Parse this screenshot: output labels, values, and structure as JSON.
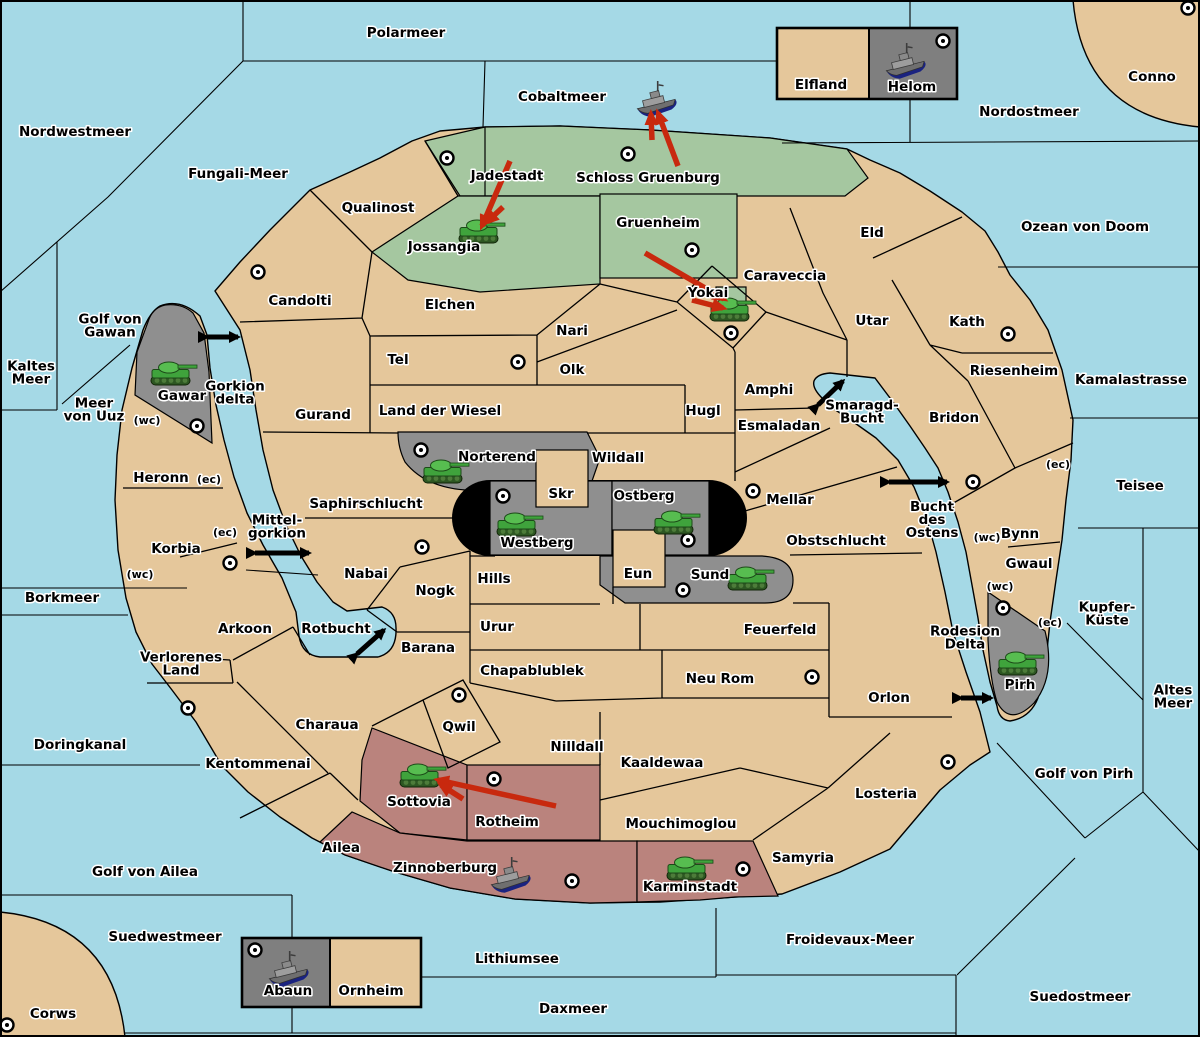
{
  "map": {
    "colors": {
      "sea": "#A5D9E6",
      "land_neutral": "#E5C79B",
      "power_green": "#A5C7A0",
      "power_gray": "#8F8F8F",
      "power_pink": "#BA837D",
      "island_box_gray": "#7F7F7F",
      "tunnel_black": "#000000",
      "order_arrow_red": "#C8290E",
      "strait_arrow_black": "#000000",
      "border": "#000000"
    },
    "sea_labels": [
      {
        "text": "Polarmeer",
        "x": 406,
        "y": 37
      },
      {
        "text": "Nordwestmeer",
        "x": 75,
        "y": 136
      },
      {
        "text": "Fungali-Meer",
        "x": 238,
        "y": 178
      },
      {
        "text": "Cobaltmeer",
        "x": 562,
        "y": 101
      },
      {
        "text": "Nordostmeer",
        "x": 1029,
        "y": 116
      },
      {
        "text": "Ozean von Doom",
        "x": 1085,
        "y": 231
      },
      {
        "text": "Kaltes\nMeer",
        "x": 31,
        "y": 377
      },
      {
        "text": "Golf von\nGawan",
        "x": 110,
        "y": 330
      },
      {
        "text": "Meer\nvon Uuz",
        "x": 94,
        "y": 414
      },
      {
        "text": "Gorkion\ndelta",
        "x": 235,
        "y": 397
      },
      {
        "text": "Mittel-\ngorkion",
        "x": 277,
        "y": 531
      },
      {
        "text": "Kamalastrasse",
        "x": 1131,
        "y": 384
      },
      {
        "text": "Smaragd-\nBucht",
        "x": 862,
        "y": 416
      },
      {
        "text": "Teisee",
        "x": 1140,
        "y": 490
      },
      {
        "text": "Bucht\ndes\nOstens",
        "x": 932,
        "y": 524
      },
      {
        "text": "Borkmeer",
        "x": 62,
        "y": 602
      },
      {
        "text": "Rotbucht",
        "x": 336,
        "y": 633
      },
      {
        "text": "Kupfer-\nKüste",
        "x": 1107,
        "y": 618
      },
      {
        "text": "Altes\nMeer",
        "x": 1173,
        "y": 701
      },
      {
        "text": "Golf von Pirh",
        "x": 1084,
        "y": 778
      },
      {
        "text": "Rodesion\nDelta",
        "x": 965,
        "y": 642
      },
      {
        "text": "Doringkanal",
        "x": 80,
        "y": 749
      },
      {
        "text": "Golf von Ailea",
        "x": 145,
        "y": 876
      },
      {
        "text": "Suedwestmeer",
        "x": 165,
        "y": 941
      },
      {
        "text": "Lithiumsee",
        "x": 517,
        "y": 963
      },
      {
        "text": "Daxmeer",
        "x": 573,
        "y": 1013
      },
      {
        "text": "Froidevaux-Meer",
        "x": 850,
        "y": 944
      },
      {
        "text": "Suedostmeer",
        "x": 1080,
        "y": 1001
      }
    ],
    "region_labels": [
      {
        "text": "Qualinost",
        "x": 378,
        "y": 212
      },
      {
        "text": "Jadestadt",
        "x": 507,
        "y": 180
      },
      {
        "text": "Schloss Gruenburg",
        "x": 648,
        "y": 182
      },
      {
        "text": "Jossangia",
        "x": 444,
        "y": 251
      },
      {
        "text": "Gruenheim",
        "x": 658,
        "y": 227
      },
      {
        "text": "Yokai",
        "x": 708,
        "y": 297
      },
      {
        "text": "Caraveccia",
        "x": 785,
        "y": 280
      },
      {
        "text": "Eld",
        "x": 872,
        "y": 237
      },
      {
        "text": "Utar",
        "x": 872,
        "y": 325
      },
      {
        "text": "Kath",
        "x": 967,
        "y": 326
      },
      {
        "text": "Riesenheim",
        "x": 1014,
        "y": 375
      },
      {
        "text": "Bridon",
        "x": 954,
        "y": 422
      },
      {
        "text": "Candolti",
        "x": 300,
        "y": 305
      },
      {
        "text": "Elchen",
        "x": 450,
        "y": 309
      },
      {
        "text": "Nari",
        "x": 572,
        "y": 335
      },
      {
        "text": "Tel",
        "x": 398,
        "y": 364
      },
      {
        "text": "Olk",
        "x": 572,
        "y": 374
      },
      {
        "text": "Gurand",
        "x": 323,
        "y": 419
      },
      {
        "text": "Land der Wiesel",
        "x": 440,
        "y": 415
      },
      {
        "text": "Hugl",
        "x": 703,
        "y": 415
      },
      {
        "text": "Amphi",
        "x": 769,
        "y": 394
      },
      {
        "text": "Esmaladan",
        "x": 779,
        "y": 430
      },
      {
        "text": "Mellar",
        "x": 790,
        "y": 504
      },
      {
        "text": "Obstschlucht",
        "x": 836,
        "y": 545
      },
      {
        "text": "Wildall",
        "x": 618,
        "y": 462
      },
      {
        "text": "Skr",
        "x": 561,
        "y": 498
      },
      {
        "text": "Ostberg",
        "x": 644,
        "y": 500
      },
      {
        "text": "Westberg",
        "x": 537,
        "y": 547
      },
      {
        "text": "Norterend",
        "x": 497,
        "y": 461
      },
      {
        "text": "Gawar",
        "x": 182,
        "y": 400
      },
      {
        "text": "Heronn",
        "x": 161,
        "y": 482
      },
      {
        "text": "Korbia",
        "x": 176,
        "y": 553
      },
      {
        "text": "Saphirschlucht",
        "x": 366,
        "y": 508
      },
      {
        "text": "Nabai",
        "x": 366,
        "y": 578
      },
      {
        "text": "Nogk",
        "x": 435,
        "y": 595
      },
      {
        "text": "Hills",
        "x": 494,
        "y": 583
      },
      {
        "text": "Eun",
        "x": 638,
        "y": 578
      },
      {
        "text": "Sund",
        "x": 710,
        "y": 579
      },
      {
        "text": "Urur",
        "x": 497,
        "y": 631
      },
      {
        "text": "Barana",
        "x": 428,
        "y": 652
      },
      {
        "text": "Chapablublek",
        "x": 532,
        "y": 675
      },
      {
        "text": "Qwil",
        "x": 459,
        "y": 731
      },
      {
        "text": "Nilldall",
        "x": 577,
        "y": 751
      },
      {
        "text": "Kaaldewaa",
        "x": 662,
        "y": 767
      },
      {
        "text": "Neu Rom",
        "x": 720,
        "y": 683
      },
      {
        "text": "Feuerfeld",
        "x": 780,
        "y": 634
      },
      {
        "text": "Orlon",
        "x": 889,
        "y": 702
      },
      {
        "text": "Mouchimoglou",
        "x": 681,
        "y": 828
      },
      {
        "text": "Arkoon",
        "x": 245,
        "y": 633
      },
      {
        "text": "Verlorenes\nLand",
        "x": 181,
        "y": 668
      },
      {
        "text": "Kentommenai",
        "x": 258,
        "y": 768
      },
      {
        "text": "Charaua",
        "x": 327,
        "y": 729
      },
      {
        "text": "Ailea",
        "x": 341,
        "y": 852
      },
      {
        "text": "Losteria",
        "x": 886,
        "y": 798
      },
      {
        "text": "Samyria",
        "x": 803,
        "y": 862
      },
      {
        "text": "Sottovia",
        "x": 419,
        "y": 806
      },
      {
        "text": "Rotheim",
        "x": 507,
        "y": 826
      },
      {
        "text": "Zinnoberburg",
        "x": 445,
        "y": 872
      },
      {
        "text": "Karminstadt",
        "x": 690,
        "y": 891
      },
      {
        "text": "Bynn",
        "x": 1020,
        "y": 538
      },
      {
        "text": "Gwaul",
        "x": 1029,
        "y": 568
      },
      {
        "text": "Pirh",
        "x": 1020,
        "y": 689
      },
      {
        "text": "Conno",
        "x": 1152,
        "y": 81
      },
      {
        "text": "Corws",
        "x": 53,
        "y": 1018
      },
      {
        "text": "Elfland",
        "x": 821,
        "y": 89
      },
      {
        "text": "Helom",
        "x": 912,
        "y": 91
      },
      {
        "text": "Abaun",
        "x": 288,
        "y": 995
      },
      {
        "text": "Ornheim",
        "x": 371,
        "y": 995
      }
    ],
    "coast_markers": [
      {
        "text": "(wc)",
        "x": 147,
        "y": 424
      },
      {
        "text": "(ec)",
        "x": 209,
        "y": 483
      },
      {
        "text": "(ec)",
        "x": 225,
        "y": 536
      },
      {
        "text": "(wc)",
        "x": 140,
        "y": 578
      },
      {
        "text": "(ec)",
        "x": 1058,
        "y": 468
      },
      {
        "text": "(wc)",
        "x": 987,
        "y": 541
      },
      {
        "text": "(wc)",
        "x": 1000,
        "y": 590
      },
      {
        "text": "(ec)",
        "x": 1050,
        "y": 626
      }
    ],
    "supply_centers": [
      {
        "region": "Candolti",
        "x": 258,
        "y": 272
      },
      {
        "region": "Jadestadt",
        "x": 447,
        "y": 158
      },
      {
        "region": "Schloss Gruenburg",
        "x": 628,
        "y": 154
      },
      {
        "region": "Gruenheim",
        "x": 692,
        "y": 250
      },
      {
        "region": "Conno",
        "x": 1188,
        "y": 8
      },
      {
        "region": "Helom",
        "x": 943,
        "y": 41
      },
      {
        "region": "Yokai",
        "x": 731,
        "y": 333
      },
      {
        "region": "Tel",
        "x": 518,
        "y": 362
      },
      {
        "region": "Kath",
        "x": 1008,
        "y": 334
      },
      {
        "region": "Gawar",
        "x": 197,
        "y": 426
      },
      {
        "region": "Korbia",
        "x": 230,
        "y": 563
      },
      {
        "region": "Nabai",
        "x": 422,
        "y": 547
      },
      {
        "region": "Norterend",
        "x": 421,
        "y": 450
      },
      {
        "region": "Westberg",
        "x": 503,
        "y": 496
      },
      {
        "region": "Ostberg",
        "x": 688,
        "y": 540
      },
      {
        "region": "Mellar",
        "x": 753,
        "y": 491
      },
      {
        "region": "Sund",
        "x": 683,
        "y": 590
      },
      {
        "region": "Bynn",
        "x": 973,
        "y": 482
      },
      {
        "region": "Pirh",
        "x": 1003,
        "y": 608
      },
      {
        "region": "Kentommenai",
        "x": 188,
        "y": 708
      },
      {
        "region": "Qwil",
        "x": 459,
        "y": 695
      },
      {
        "region": "Neu Rom",
        "x": 812,
        "y": 677
      },
      {
        "region": "Losteria",
        "x": 948,
        "y": 762
      },
      {
        "region": "Rotheim",
        "x": 494,
        "y": 779
      },
      {
        "region": "Zinnoberburg",
        "x": 572,
        "y": 881
      },
      {
        "region": "Karminstadt",
        "x": 743,
        "y": 869
      },
      {
        "region": "Corws",
        "x": 7,
        "y": 1025
      },
      {
        "region": "Abaun",
        "x": 255,
        "y": 950
      }
    ],
    "units": [
      {
        "type": "army",
        "region": "Jossangia",
        "x": 481,
        "y": 232
      },
      {
        "type": "army",
        "region": "Yokai",
        "x": 732,
        "y": 310
      },
      {
        "type": "army",
        "region": "Gawar",
        "x": 173,
        "y": 374
      },
      {
        "type": "army",
        "region": "Norterend",
        "x": 445,
        "y": 472
      },
      {
        "type": "army",
        "region": "Westberg",
        "x": 519,
        "y": 525
      },
      {
        "type": "army",
        "region": "Ostberg",
        "x": 676,
        "y": 523
      },
      {
        "type": "army",
        "region": "Sund",
        "x": 750,
        "y": 579
      },
      {
        "type": "army",
        "region": "Sottovia",
        "x": 422,
        "y": 776
      },
      {
        "type": "army",
        "region": "Karminstadt",
        "x": 689,
        "y": 869
      },
      {
        "type": "army",
        "region": "Pirh",
        "x": 1020,
        "y": 664
      },
      {
        "type": "fleet",
        "region": "Cobaltmeer",
        "x": 656,
        "y": 101
      },
      {
        "type": "fleet",
        "region": "Helom",
        "x": 905,
        "y": 63
      },
      {
        "type": "fleet",
        "region": "Zinnoberburg",
        "x": 510,
        "y": 877
      },
      {
        "type": "fleet",
        "region": "Abaun",
        "x": 288,
        "y": 971
      }
    ],
    "move_arrows": [
      {
        "x1": 510,
        "y1": 161,
        "x2": 482,
        "y2": 226
      },
      {
        "x1": 503,
        "y1": 207,
        "x2": 487,
        "y2": 222
      },
      {
        "x1": 652,
        "y1": 140,
        "x2": 651,
        "y2": 114
      },
      {
        "x1": 678,
        "y1": 166,
        "x2": 658,
        "y2": 113
      },
      {
        "x1": 645,
        "y1": 253,
        "x2": 724,
        "y2": 299
      },
      {
        "x1": 692,
        "y1": 300,
        "x2": 723,
        "y2": 308
      },
      {
        "x1": 556,
        "y1": 806,
        "x2": 438,
        "y2": 780
      },
      {
        "x1": 463,
        "y1": 799,
        "x2": 441,
        "y2": 785
      }
    ],
    "strait_arrows": [
      {
        "x1": 207,
        "y1": 337,
        "x2": 238,
        "y2": 337
      },
      {
        "x1": 255,
        "y1": 553,
        "x2": 309,
        "y2": 553
      },
      {
        "x1": 818,
        "y1": 405,
        "x2": 843,
        "y2": 381
      },
      {
        "x1": 889,
        "y1": 482,
        "x2": 947,
        "y2": 482
      },
      {
        "x1": 357,
        "y1": 654,
        "x2": 384,
        "y2": 630
      },
      {
        "x1": 961,
        "y1": 698,
        "x2": 991,
        "y2": 698
      }
    ]
  }
}
